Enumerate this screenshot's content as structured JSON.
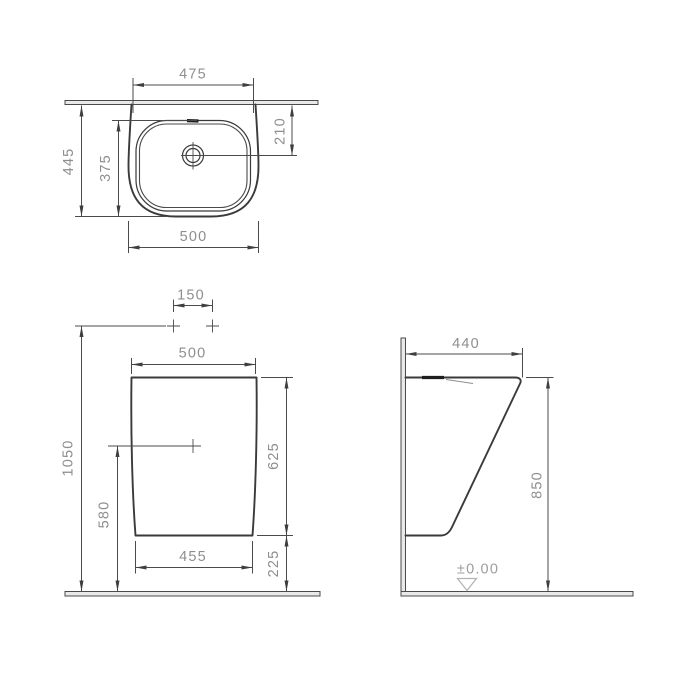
{
  "views": {
    "top": {
      "width_top": "475",
      "depth": "445",
      "bowl_depth": "375",
      "tap_to_drain": "210",
      "width": "500"
    },
    "front": {
      "hole_spacing": "150",
      "width": "500",
      "total_height": "1050",
      "drain_height": "580",
      "body_height": "625",
      "bottom_width": "455",
      "bottom_gap": "225"
    },
    "side": {
      "depth": "440",
      "height": "850",
      "floor_level": "±0.00"
    }
  }
}
